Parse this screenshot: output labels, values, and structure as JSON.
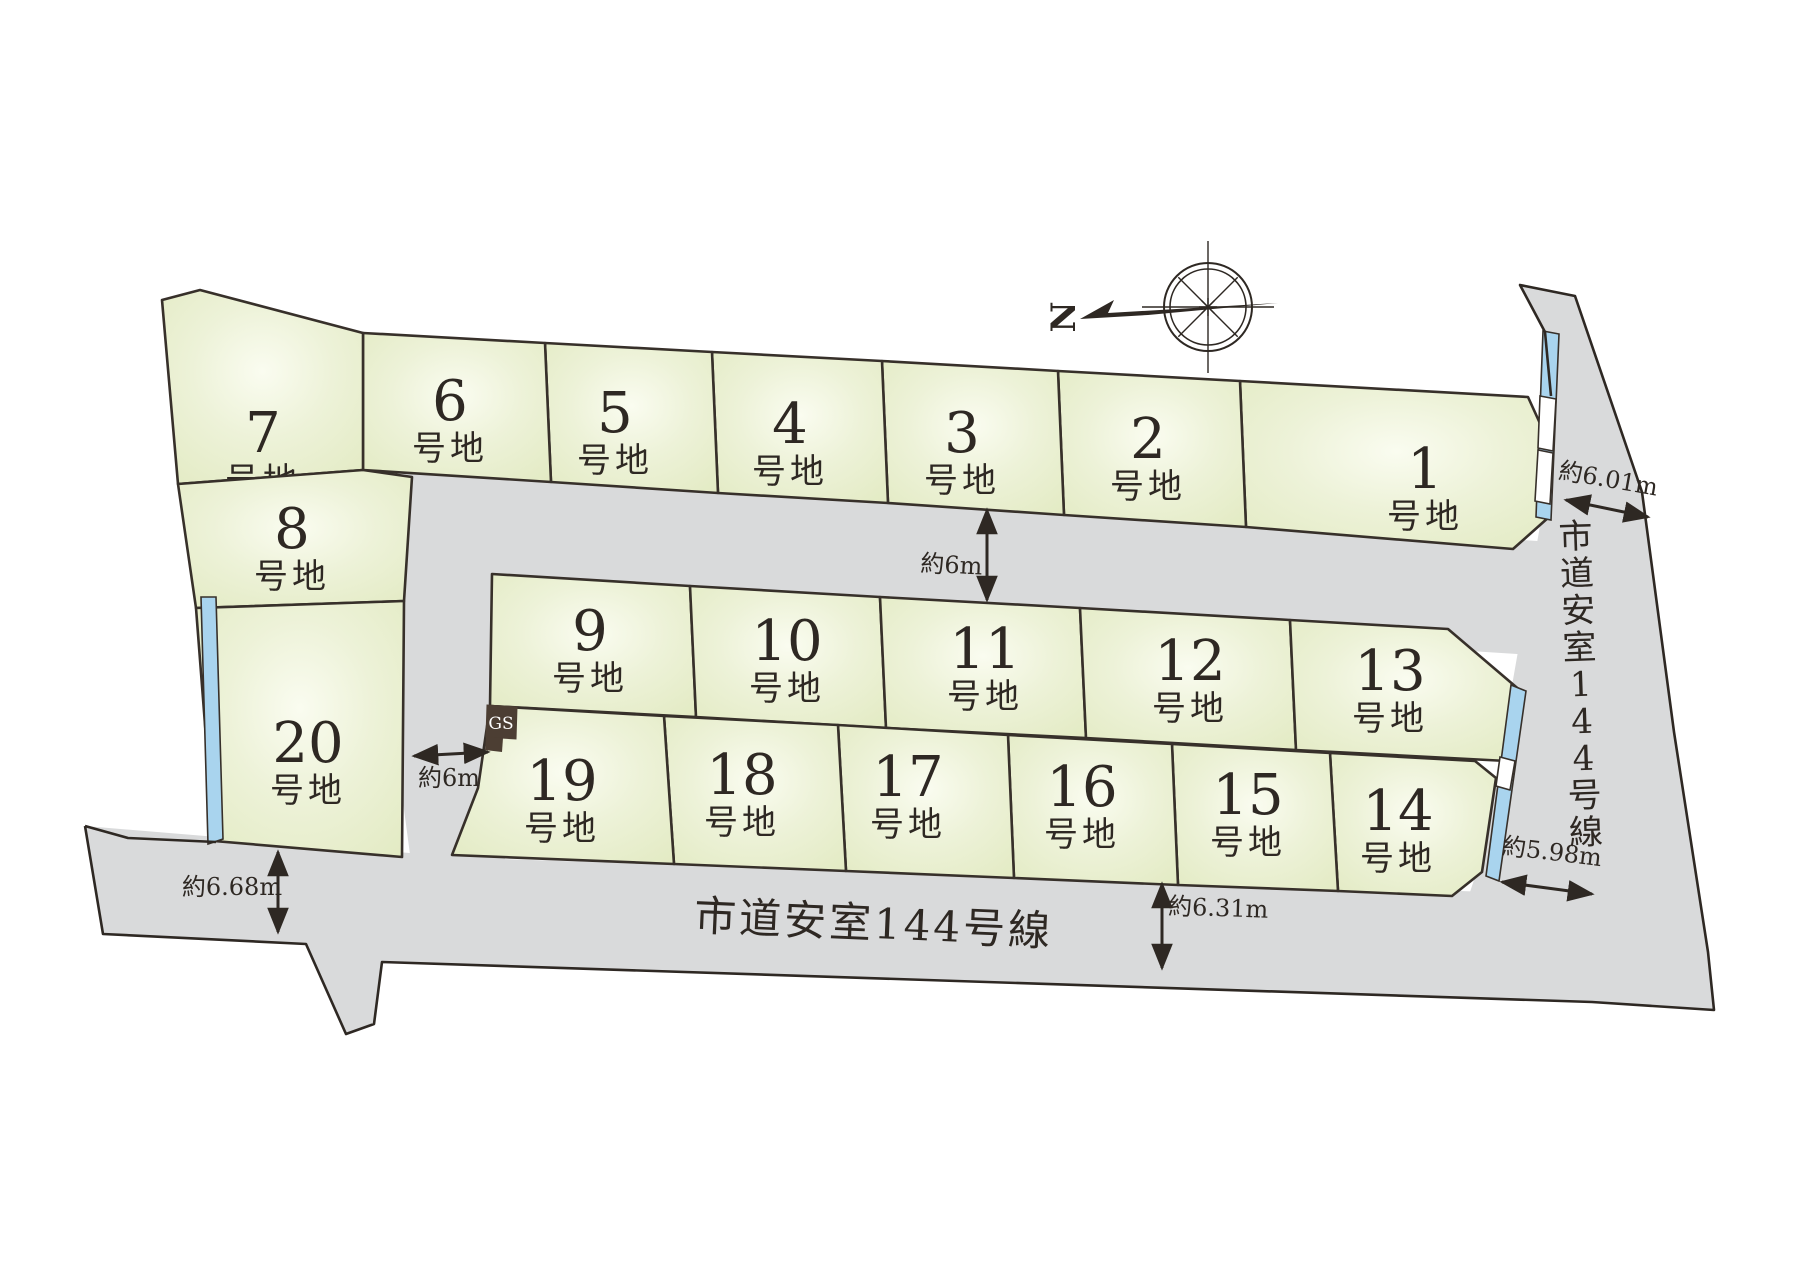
{
  "map": {
    "colors": {
      "lot_fill_center": "#fafcf0",
      "lot_fill_mid": "#edf2d8",
      "lot_fill_edge": "#e2eac2",
      "lot_stroke": "#37302a",
      "road_fill": "#d9dadb",
      "outline": "#2e2823",
      "water_blue": "#a9d4ee",
      "gs_fill": "#4c3e33",
      "gs_text": "#ffffff",
      "text": "#2e2823"
    },
    "lot_suffix": "号地",
    "lots": [
      {
        "id": "1",
        "number": "1",
        "points": "1240,381 1528,397 1553,452 1549,517 1513,549 1246,527",
        "lx": 1425,
        "ly": 488
      },
      {
        "id": "2",
        "number": "2",
        "points": "1058,371 1240,381 1246,527 1064,515",
        "lx": 1148,
        "ly": 458
      },
      {
        "id": "3",
        "number": "3",
        "points": "882,361 1058,371 1064,515 888,503",
        "lx": 962,
        "ly": 452
      },
      {
        "id": "4",
        "number": "4",
        "points": "712,352 882,361 888,503 718,493",
        "lx": 790,
        "ly": 443
      },
      {
        "id": "5",
        "number": "5",
        "points": "545,343 712,352 718,493 551,482",
        "lx": 615,
        "ly": 432
      },
      {
        "id": "6",
        "number": "6",
        "points": "363,333 545,343 551,482 363,470",
        "lx": 450,
        "ly": 420
      },
      {
        "id": "7",
        "number": "7",
        "points": "162,300 200,290 363,333 363,470 178,484",
        "lx": 263,
        "ly": 452
      },
      {
        "id": "8",
        "number": "8",
        "points": "178,484 363,470 412,477 404,601 196,608",
        "lx": 292,
        "ly": 548
      },
      {
        "id": "9",
        "number": "9",
        "points": "492,574 690,586 696,717 490,706",
        "lx": 590,
        "ly": 650
      },
      {
        "id": "10",
        "number": "10",
        "points": "690,586 880,597 886,728 696,717",
        "lx": 787,
        "ly": 660
      },
      {
        "id": "11",
        "number": "11",
        "points": "880,597 1080,608 1086,738 886,728",
        "lx": 985,
        "ly": 668
      },
      {
        "id": "12",
        "number": "12",
        "points": "1080,608 1290,620 1296,750 1086,738",
        "lx": 1190,
        "ly": 680
      },
      {
        "id": "13",
        "number": "13",
        "points": "1290,620 1448,629 1522,692 1507,761 1296,750",
        "lx": 1390,
        "ly": 690
      },
      {
        "id": "14",
        "number": "14",
        "points": "1330,753 1475,761 1496,778 1482,872 1452,896 1338,891",
        "lx": 1398,
        "ly": 830
      },
      {
        "id": "15",
        "number": "15",
        "points": "1172,744 1330,753 1338,891 1178,885",
        "lx": 1248,
        "ly": 814
      },
      {
        "id": "16",
        "number": "16",
        "points": "1008,735 1172,744 1178,885 1014,878",
        "lx": 1082,
        "ly": 806
      },
      {
        "id": "17",
        "number": "17",
        "points": "838,725 1008,735 1014,878 846,871",
        "lx": 908,
        "ly": 796
      },
      {
        "id": "18",
        "number": "18",
        "points": "664,716 838,725 846,871 674,864",
        "lx": 742,
        "ly": 794
      },
      {
        "id": "19",
        "number": "19",
        "points": "490,706 664,716 674,864 452,855 478,788",
        "lx": 562,
        "ly": 800
      },
      {
        "id": "20",
        "number": "20",
        "points": "196,608 404,601 402,857 214,841",
        "lx": 308,
        "ly": 762
      }
    ],
    "roads": [
      {
        "name": "road-right",
        "points": "1520,285 1575,296 1642,492 1674,732 1708,952 1714,1010 1596,1002 1468,898 1482,856 1520,640 1547,486 1551,396 1545,332"
      },
      {
        "name": "road-upper",
        "points": "360,464 1645,548 1645,662 418,585"
      },
      {
        "name": "road-vertical",
        "points": "358,464 505,474 505,888 415,892"
      },
      {
        "name": "road-bottom",
        "points": "85,826 470,858 1490,892 1705,936 1714,1010 1592,1002 382,962 374,1024 346,1034 306,944 103,934"
      }
    ],
    "outlines": [
      "M 85,826 L 103,934 L 306,944 L 346,1034 L 374,1024 L 382,962 L 1592,1002 L 1714,1010 L 1708,952 L 1674,732 L 1642,492 L 1575,296 L 1520,285 L 1545,332 L 1551,396",
      "M 85,826 L 128,838 L 216,842"
    ],
    "water_strips": [
      {
        "name": "water-strip-lot1",
        "kind": "blue",
        "points": "1543,331 1559,334 1551,520 1536,517"
      },
      {
        "name": "water-strip-lot1-gap1",
        "kind": "white",
        "points": "1540,396 1556,399 1553,451 1538,448"
      },
      {
        "name": "water-strip-lot1-gap2",
        "kind": "white",
        "points": "1538,450 1553,453 1550,504 1535,501"
      },
      {
        "name": "water-strip-lot13-14",
        "kind": "blue",
        "points": "1511,685 1526,691 1499,881 1486,876"
      },
      {
        "name": "water-strip-lot13-14-gap",
        "kind": "white",
        "points": "1500,757 1515,761 1510,790 1496,786"
      },
      {
        "name": "water-strip-lot20",
        "kind": "blue",
        "points": "201,597 216,597 223,839 208,844"
      }
    ],
    "gas_station": {
      "label": "GS",
      "box_points": "487,705 517,707 516,739 486,737",
      "foot_points": "486,737 503,738 502,752 485,750",
      "tx": 501,
      "ty": 729
    },
    "measurements": [
      {
        "text": "約6.01m",
        "x": 1607,
        "y": 487,
        "rot": 10,
        "arrow": [
          1566,
          500,
          1648,
          517
        ]
      },
      {
        "text": "約6m",
        "x": 951,
        "y": 573,
        "rot": 3,
        "arrow": [
          987,
          510,
          987,
          600
        ]
      },
      {
        "text": "約6m",
        "x": 449,
        "y": 786,
        "rot": 0,
        "arrow": [
          414,
          756,
          488,
          752
        ]
      },
      {
        "text": "約6.68m",
        "x": 232,
        "y": 895,
        "rot": 0,
        "arrow": [
          278,
          852,
          278,
          932
        ]
      },
      {
        "text": "約5.98m",
        "x": 1551,
        "y": 860,
        "rot": 7,
        "arrow": [
          1502,
          882,
          1592,
          894
        ]
      },
      {
        "text": "約6.31m",
        "x": 1218,
        "y": 916,
        "rot": 2,
        "arrow": [
          1162,
          884,
          1162,
          968
        ]
      }
    ],
    "road_labels": {
      "bottom": {
        "text": "市道安室144号線",
        "x": 873,
        "y": 938,
        "rot": 2.5,
        "size": 42
      },
      "right": {
        "text": "市道安室144号線",
        "x": 1581,
        "y_start": 548,
        "dy": 37,
        "rot": -2,
        "size": 34
      }
    },
    "compass": {
      "north_label": "N",
      "cx": 1208,
      "cy": 307
    }
  }
}
